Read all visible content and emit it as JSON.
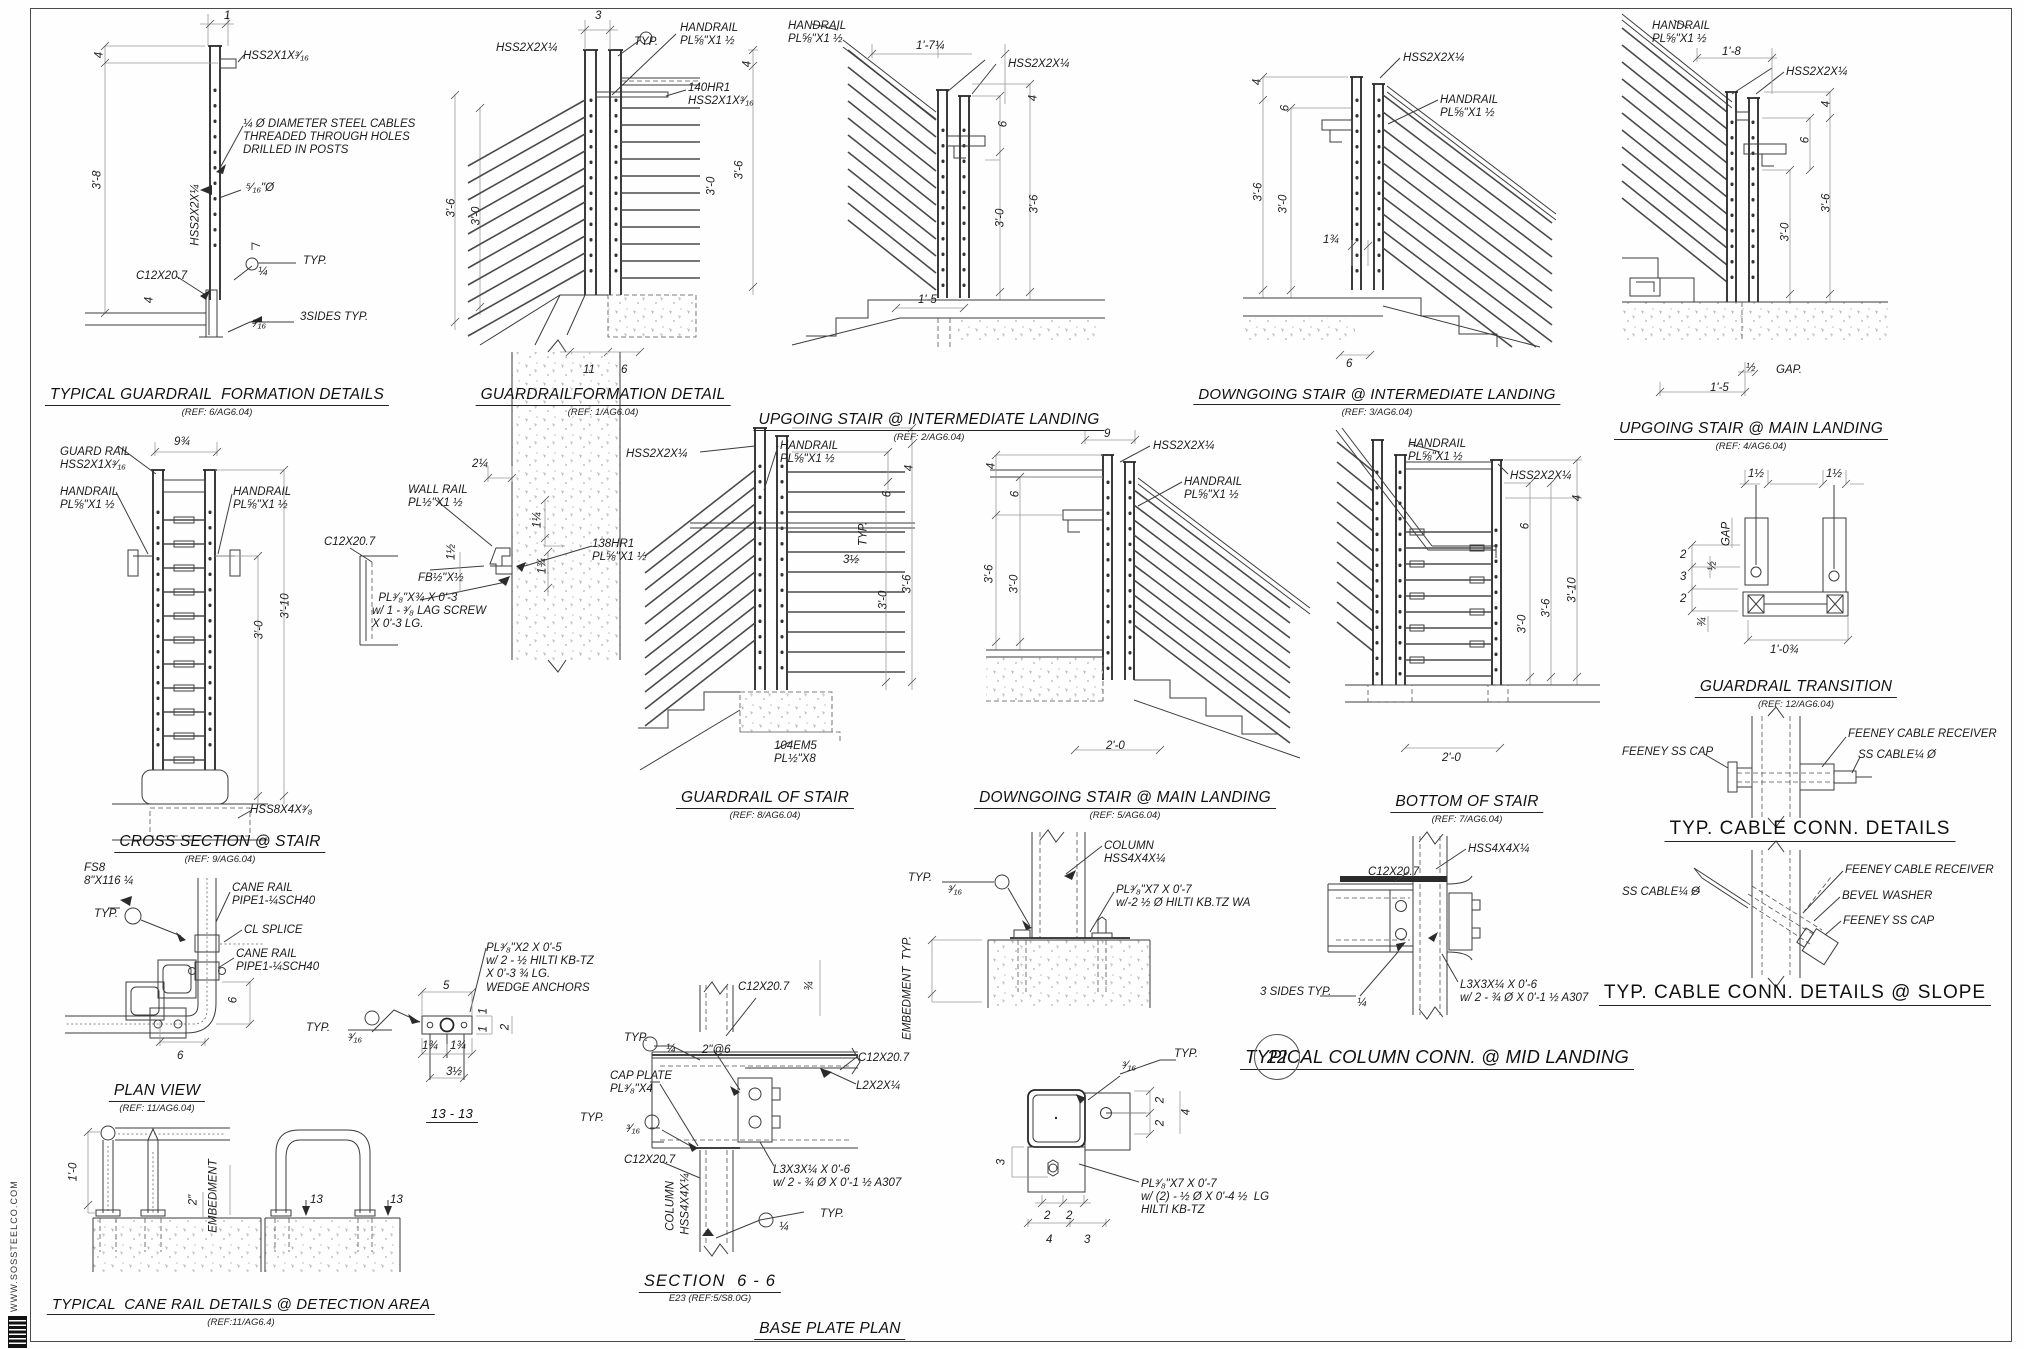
{
  "sheet": {
    "website_vertical": "WWW.SOSSTEELCO.COM",
    "line_color": "#3c3c3c",
    "bg_color": "#fefefe"
  },
  "panels": [
    {
      "id": "p1",
      "title": "TYPICAL GUARDRAIL  FORMATION DETAILS",
      "ref": "(REF: 6/AG6.04)",
      "tx": 217,
      "ty": 386,
      "labels": [
        {
          "t": "1",
          "x": 224,
          "y": 10
        },
        {
          "t": "4",
          "x": 100,
          "y": 55,
          "r": 1
        },
        {
          "t": "3'-8",
          "x": 98,
          "y": 180,
          "r": 1
        },
        {
          "t": "HSS2X1X³⁄₁₆",
          "x": 243,
          "y": 50
        },
        {
          "t": "¼ Ø DIAMETER STEEL CABLES\nTHREADED THROUGH HOLES\nDRILLED IN POSTS",
          "x": 243,
          "y": 118
        },
        {
          "t": "⁵⁄₁₆\"Ø",
          "x": 246,
          "y": 182
        },
        {
          "t": "HSS2X2X¼",
          "x": 196,
          "y": 215,
          "r": 1
        },
        {
          "t": "¼",
          "x": 258,
          "y": 266
        },
        {
          "t": "TYP.",
          "x": 303,
          "y": 255
        },
        {
          "t": "C12X20.7",
          "x": 136,
          "y": 270
        },
        {
          "t": "4",
          "x": 150,
          "y": 300,
          "r": 1
        },
        {
          "t": "³⁄₁₆",
          "x": 252,
          "y": 318
        },
        {
          "t": "3SIDES TYP.",
          "x": 300,
          "y": 311
        }
      ]
    },
    {
      "id": "p2",
      "title": "GUARDRAILFORMATION DETAIL",
      "ref": "(REF: 1/AG6.04)",
      "tx": 603,
      "ty": 386,
      "labels": [
        {
          "t": "3",
          "x": 595,
          "y": 10
        },
        {
          "t": "TYP.",
          "x": 634,
          "y": 36
        },
        {
          "t": "HSS2X2X¼",
          "x": 496,
          "y": 42
        },
        {
          "t": "HANDRAIL\nPL⅝\"X1 ½",
          "x": 680,
          "y": 22
        },
        {
          "t": "140HR1\nHSS2X1X³⁄₁₆",
          "x": 688,
          "y": 82
        },
        {
          "t": "4",
          "x": 748,
          "y": 64,
          "r": 1
        },
        {
          "t": "3'-6",
          "x": 452,
          "y": 208,
          "r": 1
        },
        {
          "t": "3'-0",
          "x": 477,
          "y": 216,
          "r": 1
        },
        {
          "t": "3'-0",
          "x": 712,
          "y": 186,
          "r": 1
        },
        {
          "t": "3'-6",
          "x": 740,
          "y": 170,
          "r": 1
        },
        {
          "t": "11",
          "x": 583,
          "y": 364
        },
        {
          "t": "6",
          "x": 621,
          "y": 364
        }
      ]
    },
    {
      "id": "p3",
      "title": "UPGOING STAIR @ INTERMEDIATE LANDING",
      "ref": "(REF: 2/AG6.04)",
      "tx": 929,
      "ty": 411,
      "labels": [
        {
          "t": "HANDRAIL\nPL⅝\"X1 ½",
          "x": 788,
          "y": 20
        },
        {
          "t": "1'-7¼",
          "x": 916,
          "y": 40
        },
        {
          "t": "HSS2X2X¼",
          "x": 1008,
          "y": 58
        },
        {
          "t": "4",
          "x": 1034,
          "y": 98,
          "r": 1
        },
        {
          "t": "6",
          "x": 1004,
          "y": 124,
          "r": 1
        },
        {
          "t": "3'-0",
          "x": 1001,
          "y": 218,
          "r": 1
        },
        {
          "t": "3'-6",
          "x": 1035,
          "y": 204,
          "r": 1
        },
        {
          "t": "1'-5",
          "x": 918,
          "y": 294
        }
      ]
    },
    {
      "id": "p4",
      "title": "DOWNGOING STAIR @ INTERMEDIATE LANDING",
      "ref": "(REF: 3/AG6.04)",
      "tx": 1377,
      "ty": 386,
      "labels": [
        {
          "t": "HSS2X2X¼",
          "x": 1403,
          "y": 52
        },
        {
          "t": "HANDRAIL\nPL⅝\"X1 ½",
          "x": 1440,
          "y": 94
        },
        {
          "t": "4",
          "x": 1258,
          "y": 82,
          "r": 1
        },
        {
          "t": "6",
          "x": 1286,
          "y": 108,
          "r": 1
        },
        {
          "t": "3'-6",
          "x": 1259,
          "y": 192,
          "r": 1
        },
        {
          "t": "3'-0",
          "x": 1284,
          "y": 204,
          "r": 1
        },
        {
          "t": "1¾",
          "x": 1323,
          "y": 234
        },
        {
          "t": "6",
          "x": 1346,
          "y": 358
        }
      ]
    },
    {
      "id": "p5",
      "title": "UPGOING STAIR @ MAIN LANDING",
      "ref": "(REF: 4/AG6.04)",
      "tx": 1751,
      "ty": 420,
      "labels": [
        {
          "t": "HANDRAIL\nPL⅝\"X1 ½",
          "x": 1652,
          "y": 20
        },
        {
          "t": "1'-8",
          "x": 1722,
          "y": 46
        },
        {
          "t": "HSS2X2X¼",
          "x": 1786,
          "y": 66
        },
        {
          "t": "4",
          "x": 1827,
          "y": 104,
          "r": 1
        },
        {
          "t": "3'-6",
          "x": 1827,
          "y": 203,
          "r": 1
        },
        {
          "t": "6",
          "x": 1806,
          "y": 140,
          "r": 1
        },
        {
          "t": "3'-0",
          "x": 1786,
          "y": 232,
          "r": 1
        },
        {
          "t": "½",
          "x": 1746,
          "y": 362
        },
        {
          "t": "GAP.",
          "x": 1776,
          "y": 364
        },
        {
          "t": "1'-5",
          "x": 1710,
          "y": 382
        }
      ]
    },
    {
      "id": "p6",
      "title": "CROSS SECTION @ STAIR",
      "ref": "(REF: 9/AG6.04)",
      "tx": 220,
      "ty": 833,
      "labels": [
        {
          "t": "9¾",
          "x": 174,
          "y": 436
        },
        {
          "t": "GUARD RAIL\nHSS2X1X³⁄₁₆",
          "x": 60,
          "y": 446
        },
        {
          "t": "HANDRAIL\nPL⅝\"X1 ½",
          "x": 60,
          "y": 486
        },
        {
          "t": "HANDRAIL\nPL⅝\"X1 ½",
          "x": 233,
          "y": 486
        },
        {
          "t": "3'-0",
          "x": 260,
          "y": 630,
          "r": 1
        },
        {
          "t": "3'-10",
          "x": 286,
          "y": 606,
          "r": 1
        },
        {
          "t": "HSS8X4X³⁄₈",
          "x": 250,
          "y": 804
        }
      ]
    },
    {
      "id": "p7",
      "labels": [
        {
          "t": "2¼",
          "x": 472,
          "y": 458
        },
        {
          "t": "WALL RAIL\nPL½\"X1 ½",
          "x": 408,
          "y": 484
        },
        {
          "t": "1½",
          "x": 452,
          "y": 552,
          "r": 1
        },
        {
          "t": "1¼",
          "x": 538,
          "y": 520,
          "r": 1
        },
        {
          "t": "1¾",
          "x": 543,
          "y": 566,
          "r": 1
        },
        {
          "t": "FB½\"X½",
          "x": 418,
          "y": 572
        },
        {
          "t": "  PL³⁄₈\"X¾ X 0'-3\nw/ 1 - ³⁄₈ LAG SCREW\nX 0'-3 LG.",
          "x": 372,
          "y": 592
        },
        {
          "t": "138HR1\nPL⅝\"X1 ½",
          "x": 592,
          "y": 538
        },
        {
          "t": "C12X20.7",
          "x": 324,
          "y": 536
        }
      ]
    },
    {
      "id": "p8",
      "title": "GUARDRAIL OF STAIR",
      "ref": "(REF: 8/AG6.04)",
      "tx": 765,
      "ty": 789,
      "labels": [
        {
          "t": "HSS2X2X¼",
          "x": 626,
          "y": 448
        },
        {
          "t": "HANDRAIL\nPL⅝\"X1 ½",
          "x": 780,
          "y": 440
        },
        {
          "t": "4",
          "x": 910,
          "y": 468,
          "r": 1
        },
        {
          "t": "6",
          "x": 888,
          "y": 494,
          "r": 1
        },
        {
          "t": "3½",
          "x": 843,
          "y": 554
        },
        {
          "t": "TYP.",
          "x": 864,
          "y": 534,
          "r": 1
        },
        {
          "t": "3'-0",
          "x": 884,
          "y": 600,
          "r": 1
        },
        {
          "t": "3'-6",
          "x": 908,
          "y": 584,
          "r": 1
        },
        {
          "t": "104EM5\nPL½\"X8",
          "x": 774,
          "y": 740
        }
      ]
    },
    {
      "id": "p9",
      "title": "DOWNGOING STAIR @ MAIN LANDING",
      "ref": "(REF: 5/AG6.04)",
      "tx": 1125,
      "ty": 789,
      "labels": [
        {
          "t": "9",
          "x": 1104,
          "y": 428
        },
        {
          "t": "HSS2X2X¼",
          "x": 1153,
          "y": 440
        },
        {
          "t": "HANDRAIL\nPL⅝\"X1 ½",
          "x": 1184,
          "y": 476
        },
        {
          "t": "4",
          "x": 992,
          "y": 466,
          "r": 1
        },
        {
          "t": "6",
          "x": 1016,
          "y": 494,
          "r": 1
        },
        {
          "t": "3'-6",
          "x": 990,
          "y": 574,
          "r": 1
        },
        {
          "t": "3'-0",
          "x": 1015,
          "y": 584,
          "r": 1
        },
        {
          "t": "2'-0",
          "x": 1106,
          "y": 740
        }
      ]
    },
    {
      "id": "p10",
      "title": "BOTTOM OF STAIR",
      "ref": "(REF: 7/AG6.04)",
      "tx": 1467,
      "ty": 793,
      "labels": [
        {
          "t": "HANDRAIL\nPL⅝\"X1 ½",
          "x": 1408,
          "y": 438
        },
        {
          "t": "HSS2X2X¼",
          "x": 1510,
          "y": 470
        },
        {
          "t": "4",
          "x": 1578,
          "y": 498,
          "r": 1
        },
        {
          "t": "6",
          "x": 1526,
          "y": 526,
          "r": 1
        },
        {
          "t": "3'-0",
          "x": 1523,
          "y": 624,
          "r": 1
        },
        {
          "t": "3'-6",
          "x": 1547,
          "y": 608,
          "r": 1
        },
        {
          "t": "3'-10",
          "x": 1573,
          "y": 590,
          "r": 1
        },
        {
          "t": "2'-0",
          "x": 1442,
          "y": 752
        }
      ]
    },
    {
      "id": "p11",
      "title": "GUARDRAIL TRANSITION",
      "ref": "(REF: 12/AG6.04)",
      "tx": 1796,
      "ty": 678,
      "labels": [
        {
          "t": "1½",
          "x": 1748,
          "y": 468
        },
        {
          "t": "1½",
          "x": 1826,
          "y": 468
        },
        {
          "t": "GAP",
          "x": 1727,
          "y": 534,
          "r": 1
        },
        {
          "t": "2",
          "x": 1680,
          "y": 549
        },
        {
          "t": "3",
          "x": 1680,
          "y": 571
        },
        {
          "t": "2",
          "x": 1680,
          "y": 593
        },
        {
          "t": "½",
          "x": 1713,
          "y": 566,
          "r": 1
        },
        {
          "t": "¾",
          "x": 1703,
          "y": 622,
          "r": 1
        },
        {
          "t": "1'-0¾",
          "x": 1770,
          "y": 644
        }
      ]
    },
    {
      "id": "p12",
      "title": "TYP. CABLE CONN. DETAILS",
      "tx": 1810,
      "ty": 818,
      "labels": [
        {
          "t": "FEENEY SS CAP",
          "x": 1622,
          "y": 746
        },
        {
          "t": "FEENEY CABLE RECEIVER",
          "x": 1848,
          "y": 728
        },
        {
          "t": "SS CABLE¼ Ø",
          "x": 1858,
          "y": 749
        }
      ]
    },
    {
      "id": "p13",
      "title": "TYP. CABLE CONN. DETAILS @ SLOPE",
      "tx": 1795,
      "ty": 982,
      "labels": [
        {
          "t": "SS CABLE¼ Ø",
          "x": 1622,
          "y": 886
        },
        {
          "t": "FEENEY CABLE RECEIVER",
          "x": 1845,
          "y": 864
        },
        {
          "t": "BEVEL WASHER",
          "x": 1842,
          "y": 890
        },
        {
          "t": "FEENEY SS CAP",
          "x": 1843,
          "y": 915
        }
      ]
    },
    {
      "id": "p14",
      "title": "PLAN VIEW",
      "ref": "(REF: 11/AG6.04)",
      "tx": 157,
      "ty": 1082,
      "labels": [
        {
          "t": "FS8\n8\"X116 ¼",
          "x": 84,
          "y": 862
        },
        {
          "t": "TYP.",
          "x": 94,
          "y": 908
        },
        {
          "t": "CANE RAIL\nPIPE1-¼SCH40",
          "x": 232,
          "y": 882
        },
        {
          "t": "CL SPLICE",
          "x": 244,
          "y": 924
        },
        {
          "t": "CANE RAIL\nPIPE1-¼SCH40",
          "x": 236,
          "y": 948
        },
        {
          "t": "6",
          "x": 234,
          "y": 1000,
          "r": 1
        },
        {
          "t": "6",
          "x": 177,
          "y": 1050
        }
      ]
    },
    {
      "id": "p15",
      "title": "TYPICAL  CANE RAIL DETAILS @ DETECTION AREA",
      "ref": "(REF:11/AG6.4)",
      "tx": 241,
      "ty": 1296,
      "labels": [
        {
          "t": "1'-0",
          "x": 74,
          "y": 1172,
          "r": 1
        },
        {
          "t": "2\"",
          "x": 194,
          "y": 1200,
          "r": 1
        },
        {
          "t": "EMBEDMENT",
          "x": 214,
          "y": 1196,
          "r": 1
        },
        {
          "t": "13",
          "x": 310,
          "y": 1194
        },
        {
          "t": "13",
          "x": 390,
          "y": 1194
        }
      ]
    },
    {
      "id": "p16",
      "title": "13 - 13",
      "tx": 452,
      "ty": 1106,
      "labels": [
        {
          "t": "PL³⁄₈\"X2 X 0'-5\nw/ 2 - ½ HILTI KB-TZ\nX 0'-3 ¾ LG.\nWEDGE ANCHORS",
          "x": 486,
          "y": 942
        },
        {
          "t": "5",
          "x": 443,
          "y": 980
        },
        {
          "t": "TYP.",
          "x": 306,
          "y": 1022
        },
        {
          "t": "³⁄₁₆",
          "x": 348,
          "y": 1032
        },
        {
          "t": "1",
          "x": 484,
          "y": 1011,
          "r": 1
        },
        {
          "t": "1",
          "x": 484,
          "y": 1029,
          "r": 1
        },
        {
          "t": "2",
          "x": 506,
          "y": 1027,
          "r": 1
        },
        {
          "t": "1¾",
          "x": 422,
          "y": 1040
        },
        {
          "t": "1¾",
          "x": 450,
          "y": 1040
        },
        {
          "t": "3½",
          "x": 446,
          "y": 1066
        }
      ]
    },
    {
      "id": "p17",
      "title": "SECTION  6 - 6",
      "ref": "E23 (REF:5/S8.0G)",
      "tx": 710,
      "ty": 1272,
      "labels": [
        {
          "t": "C12X20.7",
          "x": 738,
          "y": 981
        },
        {
          "t": "TYP.",
          "x": 624,
          "y": 1032
        },
        {
          "t": "¼",
          "x": 666,
          "y": 1043
        },
        {
          "t": "2\"@6",
          "x": 702,
          "y": 1044
        },
        {
          "t": "C12X20.7",
          "x": 858,
          "y": 1052
        },
        {
          "t": "L2X2X¼",
          "x": 856,
          "y": 1080
        },
        {
          "t": "CAP PLATE\nPL³⁄₈\"X4",
          "x": 610,
          "y": 1070
        },
        {
          "t": "TYP.",
          "x": 580,
          "y": 1112
        },
        {
          "t": "³⁄₁₆",
          "x": 626,
          "y": 1123
        },
        {
          "t": "C12X20.7",
          "x": 624,
          "y": 1154
        },
        {
          "t": "COLUMN",
          "x": 671,
          "y": 1206,
          "r": 1
        },
        {
          "t": "HSS4X4X¼",
          "x": 686,
          "y": 1204,
          "r": 1
        },
        {
          "t": "L3X3X¼ X 0'-6\nw/ 2 - ¾ Ø X 0'-1 ½ A307",
          "x": 773,
          "y": 1164
        },
        {
          "t": "¼",
          "x": 779,
          "y": 1221
        },
        {
          "t": "TYP.",
          "x": 820,
          "y": 1208
        }
      ]
    },
    {
      "id": "p18",
      "labels": [
        {
          "t": "COLUMN\nHSS4X4X¼",
          "x": 1104,
          "y": 840
        },
        {
          "t": "PL³⁄₈\"X7 X 0'-7\nw/-2 ½ Ø HILTI KB.TZ WA",
          "x": 1116,
          "y": 884
        },
        {
          "t": "TYP.",
          "x": 908,
          "y": 872
        },
        {
          "t": "³⁄₁₆",
          "x": 948,
          "y": 884
        },
        {
          "t": "EMBEDMENT  TYP.",
          "x": 908,
          "y": 988,
          "r": 1
        },
        {
          "t": "¾",
          "x": 810,
          "y": 986,
          "r": 1
        }
      ]
    },
    {
      "id": "p19",
      "title": "TYPICAL COLUMN CONN. @ MID LANDING",
      "num": "22",
      "nx": 1277,
      "ny": 1057,
      "tx": 1437,
      "ty": 1046,
      "labels": [
        {
          "t": "C12X20.7",
          "x": 1368,
          "y": 866
        },
        {
          "t": "HSS4X4X¼",
          "x": 1468,
          "y": 843
        },
        {
          "t": "3 SIDES TYP.",
          "x": 1260,
          "y": 986
        },
        {
          "t": "¼",
          "x": 1357,
          "y": 997
        },
        {
          "t": "L3X3X¼ X 0'-6\nw/ 2 - ¾ Ø X 0'-1 ½ A307",
          "x": 1460,
          "y": 979
        }
      ]
    },
    {
      "id": "p20",
      "title": "BASE PLATE PLAN",
      "tx": 830,
      "ty": 1320,
      "labels": [
        {
          "t": "TYP.",
          "x": 1174,
          "y": 1048
        },
        {
          "t": "³⁄₁₆",
          "x": 1122,
          "y": 1060
        },
        {
          "t": "2",
          "x": 1161,
          "y": 1100,
          "r": 1
        },
        {
          "t": "2",
          "x": 1161,
          "y": 1123,
          "r": 1
        },
        {
          "t": "4",
          "x": 1187,
          "y": 1112,
          "r": 1
        },
        {
          "t": "3",
          "x": 1002,
          "y": 1162,
          "r": 1
        },
        {
          "t": "2",
          "x": 1044,
          "y": 1210
        },
        {
          "t": "2",
          "x": 1066,
          "y": 1210
        },
        {
          "t": "4",
          "x": 1046,
          "y": 1234
        },
        {
          "t": "3",
          "x": 1084,
          "y": 1234
        },
        {
          "t": "PL³⁄₈\"X7 X 0'-7\nw/ (2) - ½ Ø X 0'-4 ½  LG\nHILTI KB-TZ",
          "x": 1141,
          "y": 1178
        }
      ]
    }
  ]
}
